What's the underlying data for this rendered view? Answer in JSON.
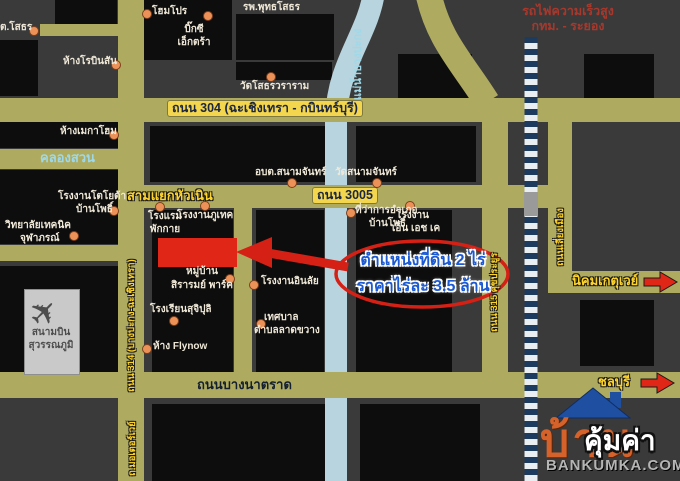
{
  "map": {
    "landmarks": {
      "sothon": "ต.โสธร",
      "homepro": "โฮมโปร",
      "bigc_line1": "บิ๊กซี",
      "bigc_line2": "เอ็กตร้า",
      "hospital": "รพ.พุทธโสธร",
      "robinson": "ห้างโรบินสัน",
      "wat_sothon": "วัดโสธรวราราม",
      "megahome": "ห้างเมกาโฮม",
      "toyota_line1": "โรงงานโตโยต้า",
      "toyota_line2": "บ้านโพธิ์",
      "technic_line1": "วิทยาลัยเทคนิค",
      "technic_line2": "จุฬาภรณ์",
      "obt_sanamchan": "อบต.สนามจันทร์",
      "wat_sanamchan": "วัดสนามจันทร์",
      "amphoe_line1": "ที่ว่าการอำเภอ",
      "amphoe_line2": "บ้านโพธิ์",
      "hotel_line1": "โรงแรม",
      "hotel_line2": "พักกาย",
      "putech": "โรงงานภูเทค",
      "nhk_line1": "โรงงาน",
      "nhk_line2": "เอ็น เอช เค",
      "sirarom_line1": "หมู่บ้าน",
      "sirarom_line2": "สิรารมย์ พาร์ค",
      "inlai": "โรงงานอินลัย",
      "tessaban_line1": "เทศบาล",
      "tessaban_line2": "ตำบลลาดขวาง",
      "sujipuli": "โรงเรียนสุจิปุลิ",
      "flynow": "ห้าง Flynow",
      "airport_line1": "สนามบิน",
      "airport_line2": "สุวรรณภูมิ"
    },
    "roads": {
      "road304": "ถนน 304 (ฉะเชิงเทรา - กบินทร์บุรี)",
      "road3005": "ถนน 3005",
      "samyaek": "สามแยกหัวเนิน",
      "khlongsuan": "คลองสวน",
      "bangna_trat": "ถนนบางนาตราด",
      "road314": "ถนน 314 (บางปะกง-ฉะเชิงเทรา)",
      "road315": "ถนน 315 ศุขประยูร",
      "bypass": "ถนนเลี่ยงเมือง",
      "motorway": "ถ.มอเตอร์เวย์",
      "river": "แม่น้ำบางปะกง"
    },
    "rail": {
      "hsr_line1": "รถไฟความเร็วสูง",
      "hsr_line2": "กทม. - ระยอง"
    },
    "destinations": {
      "gateway": "นิคมเกตุเวย์",
      "chonburi": "ชลบุรี"
    },
    "annotation": {
      "line1": "ตำแหน่งที่ดิน 2 ไร่",
      "line2": "ราคาไร่ละ 3.5 ล้าน"
    },
    "icons": {
      "airplane": "✈"
    },
    "logo": {
      "house_text": "บ้าน",
      "overlay": "คุ้มค่า",
      "site": "BANKUMKA.COM"
    },
    "colors": {
      "background": "#3a3a3a",
      "road": "#aeab60",
      "building": "#0d0d0d",
      "river": "#b8d4de",
      "rail_navy": "#1d3a5f",
      "accent_red": "#d42015",
      "plot_red": "#e02717",
      "label_yellow": "#ffd42a",
      "annotation_blue": "#1b5ad2",
      "logo_orange": "#d4622a",
      "logo_roof": "#1f4fa0"
    }
  }
}
